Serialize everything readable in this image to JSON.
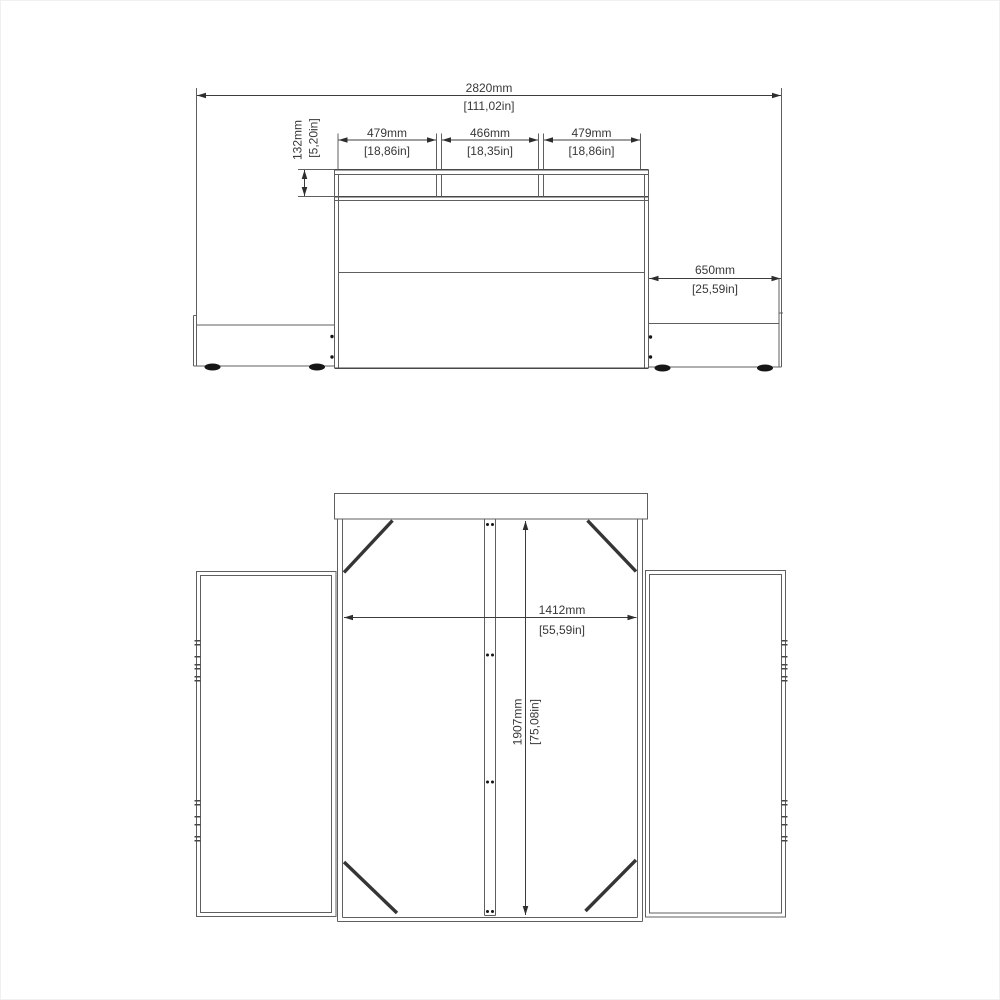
{
  "drawing": {
    "front_view": {
      "overall_width": {
        "mm": "2820mm",
        "inches": "[111,02in]"
      },
      "shelf_height": {
        "mm": "132mm",
        "inches": "[5,20in]"
      },
      "shelf_compartments": [
        {
          "mm": "479mm",
          "inches": "[18,86in]"
        },
        {
          "mm": "466mm",
          "inches": "[18,35in]"
        },
        {
          "mm": "479mm",
          "inches": "[18,86in]"
        }
      ],
      "right_unit_width": {
        "mm": "650mm",
        "inches": "[25,59in]"
      }
    },
    "top_view": {
      "inner_width": {
        "mm": "1412mm",
        "inches": "[55,59in]"
      },
      "inner_depth": {
        "mm": "1907mm",
        "inches": "[75,08in]"
      }
    },
    "colors": {
      "background": "#ffffff",
      "line": "#5f5f5f",
      "dark_line": "#474747",
      "text": "#383838"
    }
  }
}
